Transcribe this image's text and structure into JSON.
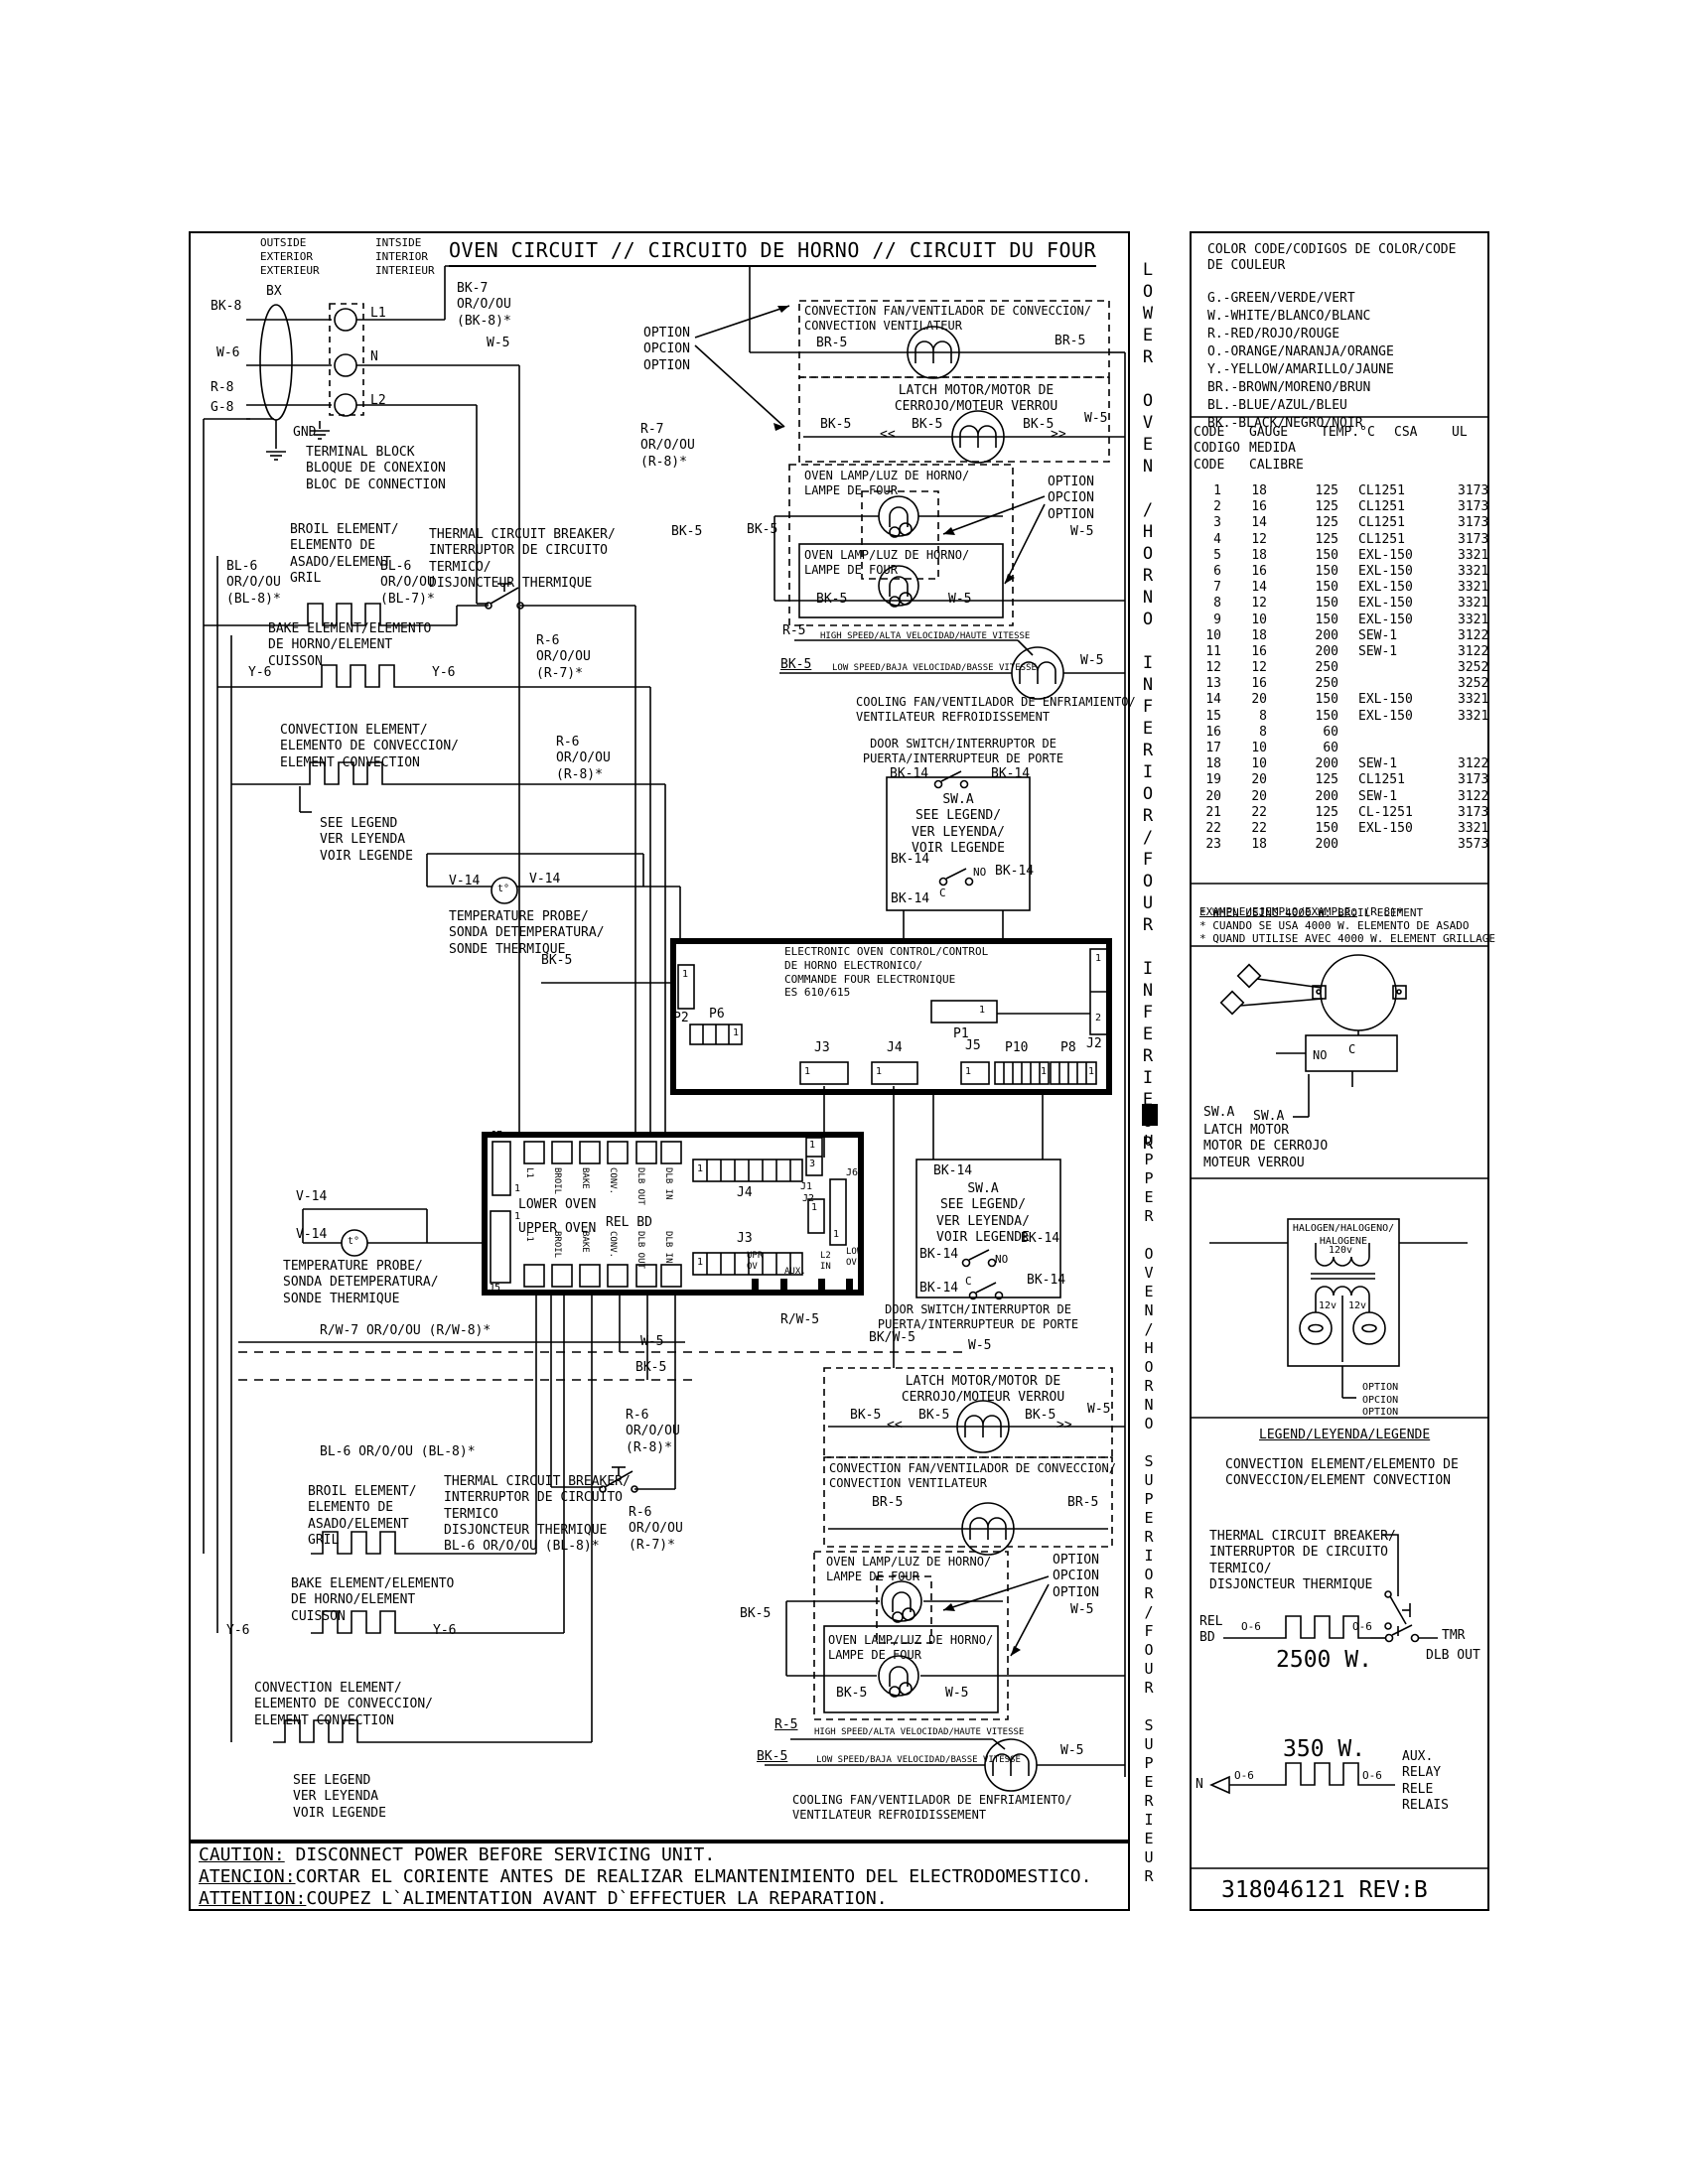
{
  "colors": {
    "ink": "#000000",
    "paper": "#ffffff"
  },
  "page": {
    "title": "OVEN CIRCUIT // CIRCUITO DE HORNO // CIRCUIT DU FOUR",
    "part_number": "318046121 REV:B",
    "caution_lines": [
      {
        "label": "CAUTION:",
        "text": " DISCONNECT POWER BEFORE SERVICING UNIT."
      },
      {
        "label": "ATENCION:",
        "text": "CORTAR EL CORIENTE ANTES DE REALIZAR ELMANTENIMIENTO DEL ELECTRODOMESTICO."
      },
      {
        "label": "ATTENTION:",
        "text": "COUPEZ L`ALIMENTATION AVANT D`EFFECTUER LA REPARATION."
      }
    ]
  },
  "sidebar": {
    "lower": "LOWER OVEN /HORNO INFERIOR/FOUR INFERIEUR",
    "upper": "UPPER OVEN/HORNO SUPERIOR/FOUR SUPERIEUR"
  },
  "tokens": {
    "bk5": "BK-5",
    "w5": "W-5",
    "br5": "BR-5",
    "bk14": "BK-14",
    "r5": "R-5",
    "y6": "Y-6",
    "v14": "V-14",
    "no": "NO",
    "c": "C",
    "one": "1",
    "two": "2",
    "three": "3",
    "chev_l": "<<",
    "chev_r": ">>",
    "bkw5": "BK/W-5",
    "rw5": "R/W-5",
    "t": "t°",
    "option": "OPTION\nOPCION\nOPTION"
  },
  "top": {
    "outside": "OUTSIDE\nEXTERIOR\nEXTERIEUR",
    "inside": "INTSIDE\nINTERIOR\nINTERIEUR",
    "bx": "BX",
    "bk8": "BK-8",
    "w6": "W-6",
    "r8": "R-8",
    "g8": "G-8",
    "gnd": "GND",
    "l1": "L1",
    "n": "N",
    "l2": "L2",
    "terminal_block": "TERMINAL BLOCK\nBLOQUE DE CONEXION\nBLOC DE CONNECTION",
    "bk7": "BK-7\nOR/O/OU\n(BK-8)*",
    "r7": "R-7\nOR/O/OU\n(R-8)*"
  },
  "lower_oven": {
    "broil": "BROIL ELEMENT/\nELEMENTO DE\nASADO/ELEMENT\nGRIL",
    "bl6_8": "BL-6\nOR/O/OU\n(BL-8)*",
    "bl6_7": "BL-6\nOR/O/OU\n(BL-7)*",
    "breaker": "THERMAL CIRCUIT BREAKER/\nINTERRUPTOR DE CIRCUITO\nTERMICO/\nDISJONCTEUR THERMIQUE",
    "r6_7": "R-6\nOR/O/OU\n(R-7)*",
    "r6_8": "R-6\nOR/O/OU\n(R-8)*",
    "bake": "BAKE ELEMENT/ELEMENTO\nDE HORNO/ELEMENT\nCUISSON",
    "conv": "CONVECTION ELEMENT/\nELEMENTO DE CONVECCION/\nELEMENT CONVECTION",
    "see_legend": "SEE LEGEND\nVER LEYENDA\nVOIR LEGENDE",
    "probe": "TEMPERATURE PROBE/\nSONDA DETEMPERATURA/\nSONDE THERMIQUE",
    "conv_fan": "CONVECTION FAN/VENTILADOR DE CONVECCION/\nCONVECTION VENTILATEUR",
    "latch": "LATCH MOTOR/MOTOR DE\nCERROJO/MOTEUR VERROU",
    "lamp": "OVEN LAMP/LUZ DE HORNO/\nLAMPE DE FOUR",
    "high": "HIGH SPEED/ALTA VELOCIDAD/HAUTE VITESSE",
    "low": "LOW SPEED/BAJA VELOCIDAD/BASSE VITESSE",
    "cooling": "COOLING FAN/VENTILADOR DE ENFRIAMIENTO/\nVENTILATEUR REFROIDISSEMENT",
    "door": "DOOR SWITCH/INTERRUPTOR DE\nPUERTA/INTERRUPTEUR DE PORTE",
    "swa": "SW.A\nSEE LEGEND/\nVER LEYENDA/\nVOIR LEGENDE"
  },
  "upper_oven": {
    "rw7": "R/W-7 OR/O/OU (R/W-8)*",
    "bl6_line": "BL-6 OR/O/OU (BL-8)*",
    "bl6_line2": "BL-6 OR/O/OU (BL-8)*",
    "broil": "BROIL ELEMENT/\nELEMENTO DE\nASADO/ELEMENT\nGRIL",
    "breaker": "THERMAL CIRCUIT BREAKER/\nINTERRUPTOR DE CIRCUITO\nTERMICO\nDISJONCTEUR THERMIQUE",
    "r6_8": "R-6\nOR/O/OU\n(R-8)*",
    "r6_7": "R-6\nOR/O/OU\n(R-7)*",
    "bake": "BAKE ELEMENT/ELEMENTO\nDE HORNO/ELEMENT\nCUISSON",
    "conv": "CONVECTION ELEMENT/\nELEMENTO DE CONVECCION/\nELEMENT CONVECTION",
    "see_legend": "SEE LEGEND\nVER LEYENDA\nVOIR LEGENDE",
    "probe": "TEMPERATURE PROBE/\nSONDA DETEMPERATURA/\nSONDE THERMIQUE",
    "latch": "LATCH MOTOR/MOTOR DE\nCERROJO/MOTEUR VERROU",
    "conv_fan": "CONVECTION FAN/VENTILADOR DE CONVECCION/\nCONVECTION VENTILATEUR",
    "lamp": "OVEN LAMP/LUZ DE HORNO/\nLAMPE DE FOUR",
    "high": "HIGH SPEED/ALTA VELOCIDAD/HAUTE VITESSE",
    "low": "LOW SPEED/BAJA VELOCIDAD/BASSE VITESSE",
    "cooling": "COOLING FAN/VENTILADOR DE ENFRIAMIENTO/\nVENTILATEUR REFROIDISSEMENT"
  },
  "eoc": {
    "label": "ELECTRONIC OVEN CONTROL/CONTROL\nDE HORNO ELECTRONICO/\nCOMMANDE FOUR ELECTRONIQUE\nES 610/615",
    "p1": "P1",
    "p2": "P2",
    "p6": "P6",
    "j3": "J3",
    "j4": "J4",
    "j5": "J5",
    "p10": "P10",
    "p8": "P8",
    "j2": "J2"
  },
  "relay_board": {
    "lower": "LOWER OVEN",
    "upper": "UPPER OVEN",
    "rel_bd": "REL BD",
    "pins": [
      "L1",
      "BROIL",
      "BAKE",
      "CONV.",
      "DLB OUT",
      "DLB IN"
    ],
    "j1": "J1",
    "j2": "J2",
    "j3": "J3",
    "j4": "J4",
    "j5": "J5",
    "j6": "J6",
    "j7": "J7",
    "upr_ov": "UPR\nOV",
    "aux": "AUX.",
    "l2_in": "L2\nIN",
    "low_ov": "LOW\nOV"
  },
  "right_panel": {
    "color_code": {
      "title": "COLOR CODE/CODIGOS DE COLOR/CODE\nDE COULEUR",
      "items": [
        "G.-GREEN/VERDE/VERT",
        "W.-WHITE/BLANCO/BLANC",
        "R.-RED/ROJO/ROUGE",
        "O.-ORANGE/NARANJA/ORANGE",
        "Y.-YELLOW/AMARILLO/JAUNE",
        "BR.-BROWN/MORENO/BRUN",
        "BL.-BLUE/AZUL/BLEU",
        "BK.-BLACK/NEGRO/NOIR"
      ]
    },
    "wire_table": {
      "headers": {
        "code": "CODE\nCODIGO\nCODE",
        "gauge": "GAUGE\nMEDIDA\nCALIBRE",
        "temp": "TEMP.°C",
        "csa": "CSA",
        "ul": "UL"
      },
      "rows": [
        [
          "1",
          "18",
          "125",
          "CL1251",
          "3173"
        ],
        [
          "2",
          "16",
          "125",
          "CL1251",
          "3173"
        ],
        [
          "3",
          "14",
          "125",
          "CL1251",
          "3173"
        ],
        [
          "4",
          "12",
          "125",
          "CL1251",
          "3173"
        ],
        [
          "5",
          "18",
          "150",
          "EXL-150",
          "3321"
        ],
        [
          "6",
          "16",
          "150",
          "EXL-150",
          "3321"
        ],
        [
          "7",
          "14",
          "150",
          "EXL-150",
          "3321"
        ],
        [
          "8",
          "12",
          "150",
          "EXL-150",
          "3321"
        ],
        [
          "9",
          "10",
          "150",
          "EXL-150",
          "3321"
        ],
        [
          "10",
          "18",
          "200",
          "SEW-1",
          "3122"
        ],
        [
          "11",
          "16",
          "200",
          "SEW-1",
          "3122"
        ],
        [
          "12",
          "12",
          "250",
          "",
          "3252"
        ],
        [
          "13",
          "16",
          "250",
          "",
          "3252"
        ],
        [
          "14",
          "20",
          "150",
          "EXL-150",
          "3321"
        ],
        [
          "15",
          "8",
          "150",
          "EXL-150",
          "3321"
        ],
        [
          "16",
          "8",
          "60",
          "",
          ""
        ],
        [
          "17",
          "10",
          "60",
          "",
          ""
        ],
        [
          "18",
          "10",
          "200",
          "SEW-1",
          "3122"
        ],
        [
          "19",
          "20",
          "125",
          "CL1251",
          "3173"
        ],
        [
          "20",
          "20",
          "200",
          "SEW-1",
          "3122"
        ],
        [
          "21",
          "22",
          "125",
          "CL-1251",
          "3173"
        ],
        [
          "22",
          "22",
          "150",
          "EXL-150",
          "3321"
        ],
        [
          "23",
          "18",
          "200",
          "",
          "3573"
        ]
      ]
    },
    "example": {
      "title": "EXAMPLE/EJEMPLO/EXAMPLE:",
      "suffix": " (R-8)*",
      "notes": [
        "* WHEN USING 4000 W. BROIL ELEMENT",
        "* CUANDO SE USA 4000 W. ELEMENTO DE ASADO",
        "* QUAND UTILISE AVEC 4000 W. ELEMENT GRILLAGE"
      ]
    },
    "latch": {
      "no": "NO",
      "c": "C",
      "swa1": "SW.A",
      "swa2": "SW.A",
      "caption": "LATCH MOTOR\nMOTOR DE CERROJO\nMOTEUR VERROU"
    },
    "halogen": {
      "title": "HALOGEN/HALOGENO/\nHALOGENE",
      "v120": "120v",
      "v12a": "12v",
      "v12b": "12v",
      "option": "OPTION\nOPCION\nOPTION"
    },
    "legend": {
      "title": "LEGEND/LEYENDA/LEGENDE",
      "conv": "CONVECTION ELEMENT/ELEMENTO DE\nCONVECCION/ELEMENT CONVECTION",
      "breaker": "THERMAL CIRCUIT BREAKER/\nINTERRUPTOR DE CIRCUITO\nTERMICO/\nDISJONCTEUR THERMIQUE",
      "rel_bd": "REL\nBD",
      "o6": "O-6",
      "tmr": "TMR",
      "dlb_out": "DLB OUT",
      "w2500": "2500 W.",
      "w350": "350 W.",
      "n": "N",
      "aux": "AUX.\nRELAY\nRELE\nRELAIS"
    }
  }
}
